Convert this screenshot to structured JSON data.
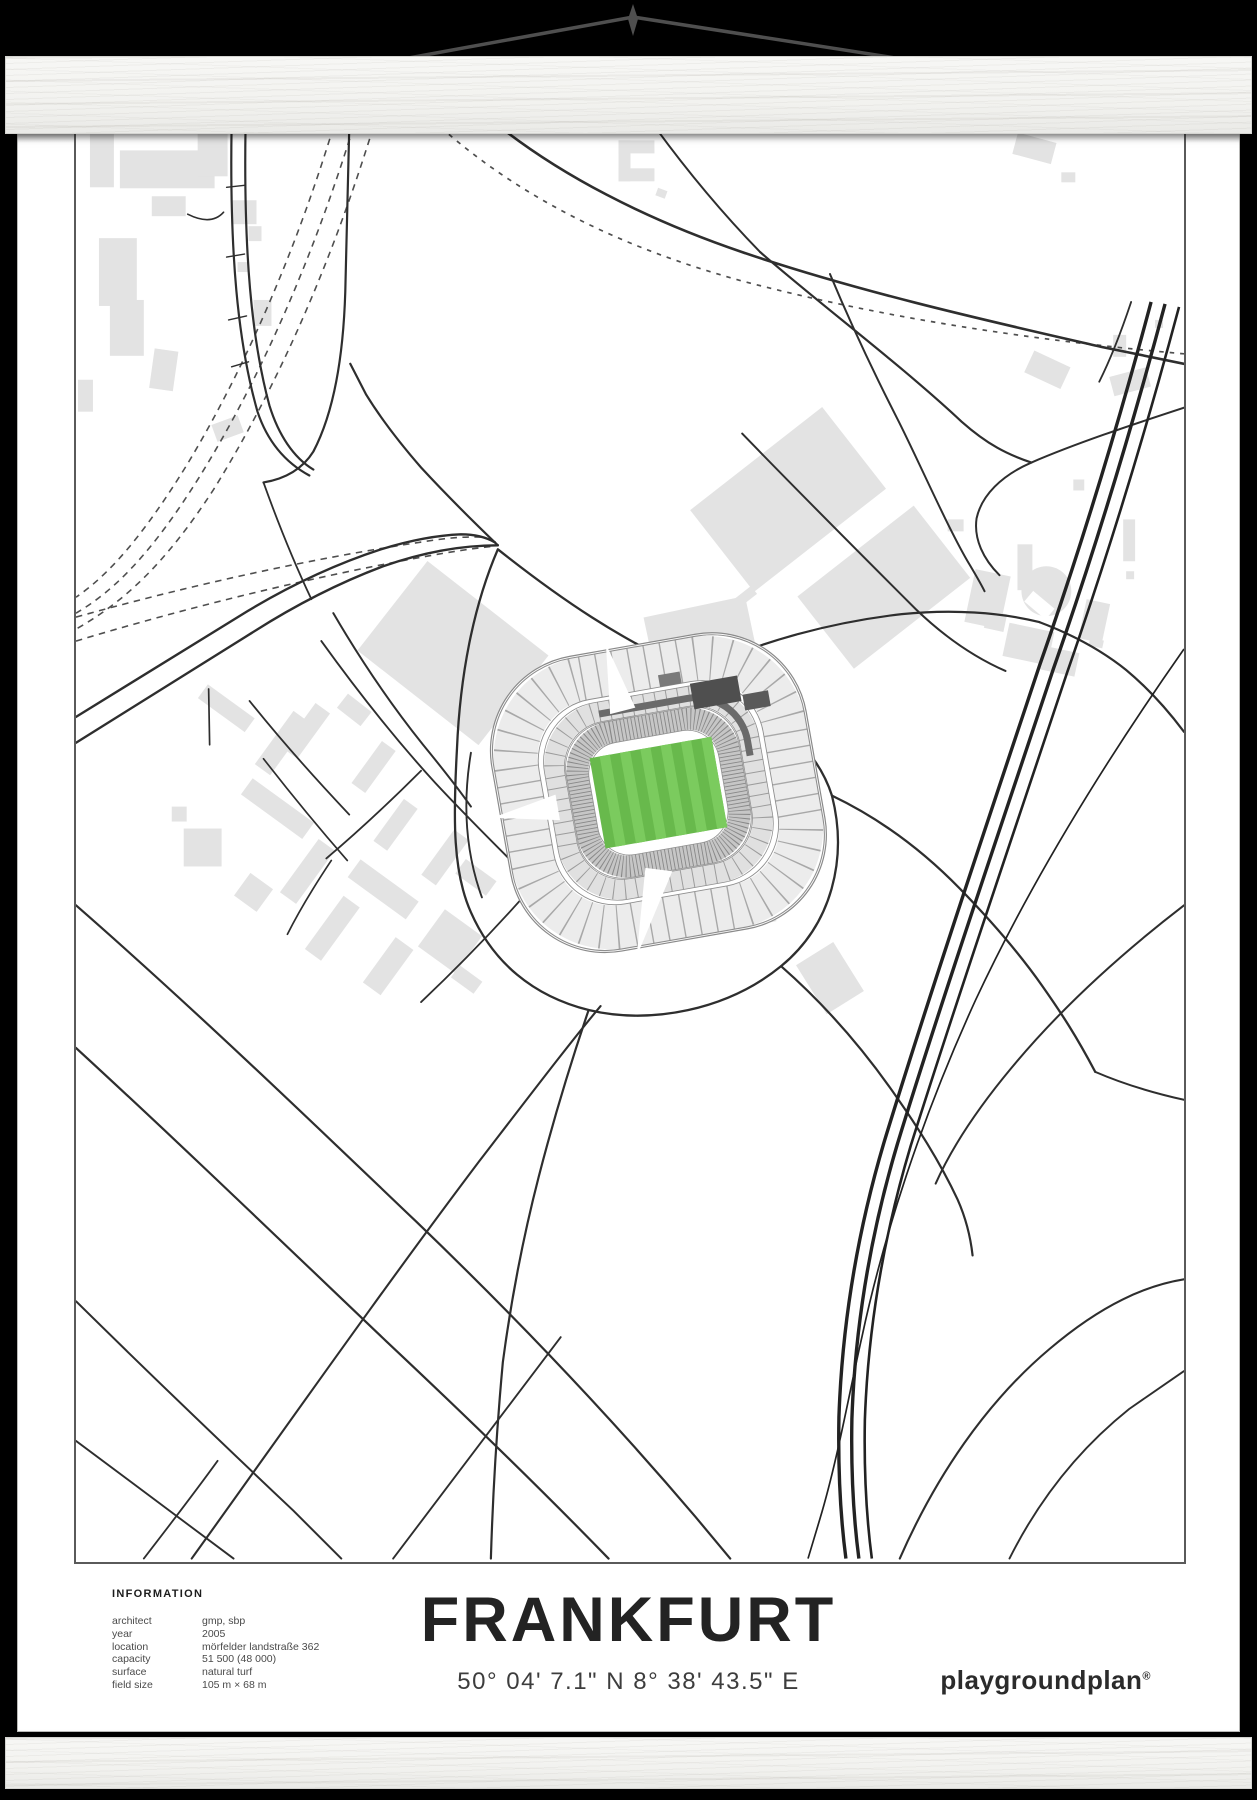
{
  "poster": {
    "title": "FRANKFURT",
    "coordinates": "50° 04' 7.1\" N  8° 38' 43.5\" E",
    "brand": "playgroundplan",
    "brand_mark": "®",
    "info": {
      "heading": "INFORMATION",
      "rows": [
        {
          "label": "architect",
          "value": "gmp, sbp"
        },
        {
          "label": "year",
          "value": "2005"
        },
        {
          "label": "location",
          "value": "mörfelder landstraße 362"
        },
        {
          "label": "capacity",
          "value": "51 500 (48 000)"
        },
        {
          "label": "surface",
          "value": "natural turf"
        },
        {
          "label": "field size",
          "value": "105 m × 68 m"
        }
      ]
    }
  },
  "map": {
    "subject": "stadium-frankfurt-waldstadion",
    "road_color": "#2e2e2e",
    "railway_style": "dashed",
    "building_color": "#e3e3e3",
    "pitch_color": "#68b94c",
    "pitch_stripe_color": "#7bcb5e",
    "stand_color": "#ececec",
    "roof_color": "#6a6a6a",
    "background": "#ffffff"
  },
  "frame": {
    "wood_color": "#f4f4f2",
    "string_color": "#4f4f4f",
    "background": "#000000"
  }
}
